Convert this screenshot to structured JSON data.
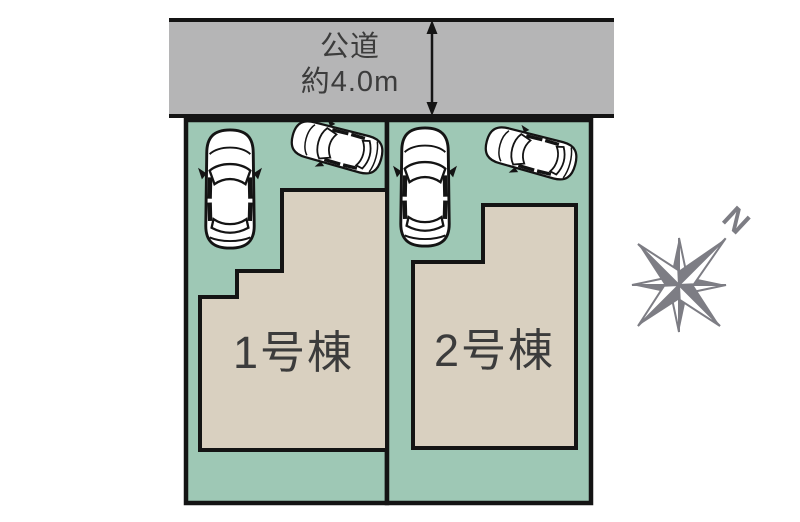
{
  "site_plan": {
    "road": {
      "name": "公道",
      "width_label": "約4.0m"
    },
    "lots": [
      {
        "building_label": "1号棟"
      },
      {
        "building_label": "2号棟"
      }
    ],
    "compass": {
      "north_label": "N"
    },
    "colors": {
      "road_fill": "#b5b5b6",
      "lot_fill": "#9ec8b5",
      "building_fill": "#d9d0c0",
      "outline": "#141414",
      "label_text": "#3c3c3c",
      "compass_gray": "#7d7d84"
    }
  }
}
